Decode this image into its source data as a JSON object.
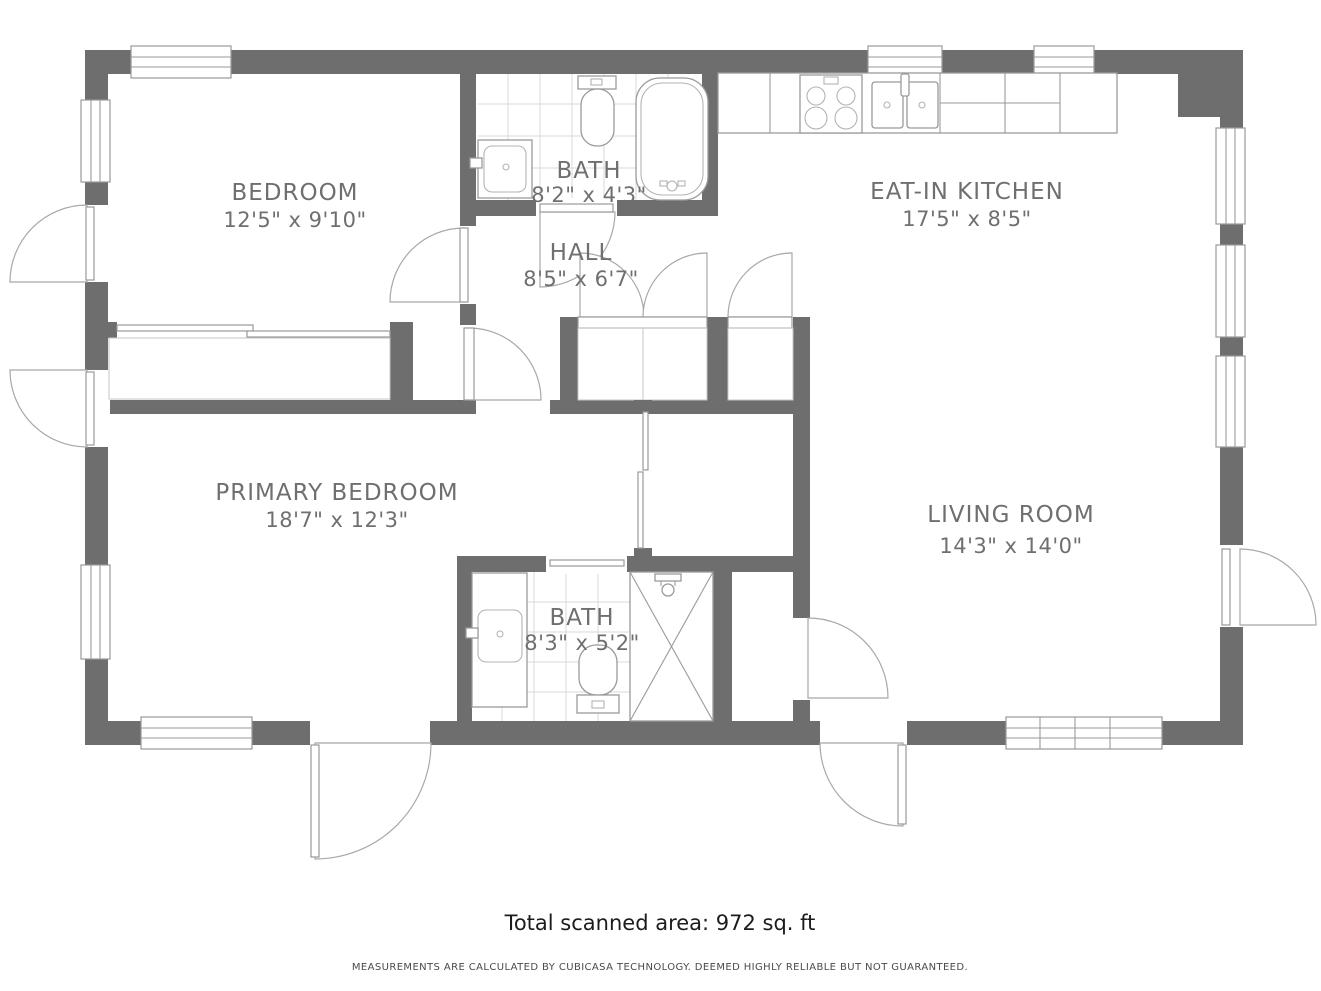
{
  "rooms": {
    "bedroom": {
      "name": "BEDROOM",
      "dims": "12'5\" x 9'10\""
    },
    "bath_top": {
      "name": "BATH",
      "dims": "8'2\" x 4'3\""
    },
    "hall": {
      "name": "HALL",
      "dims": "8'5\" x 6'7\""
    },
    "kitchen": {
      "name": "EAT-IN KITCHEN",
      "dims": "17'5\" x 8'5\""
    },
    "primary_bedroom": {
      "name": "PRIMARY BEDROOM",
      "dims": "18'7\" x 12'3\""
    },
    "bath_bottom": {
      "name": "BATH",
      "dims": "8'3\" x 5'2\""
    },
    "living_room": {
      "name": "LIVING ROOM",
      "dims": "14'3\" x 14'0\""
    }
  },
  "footer": {
    "total_area": "Total scanned area: 972 sq. ft",
    "disclaimer": "MEASUREMENTS ARE CALCULATED BY CUBICASA TECHNOLOGY. DEEMED HIGHLY RELIABLE BUT NOT GUARANTEED."
  },
  "colors": {
    "wall": "#6e6e6e",
    "label_text": "#6f6f6f",
    "tile_line": "#d8d8d8",
    "fixture_line": "#9a9a9a",
    "footer_text": "#1c1c1c",
    "disclaimer_text": "#4a4a4a"
  }
}
